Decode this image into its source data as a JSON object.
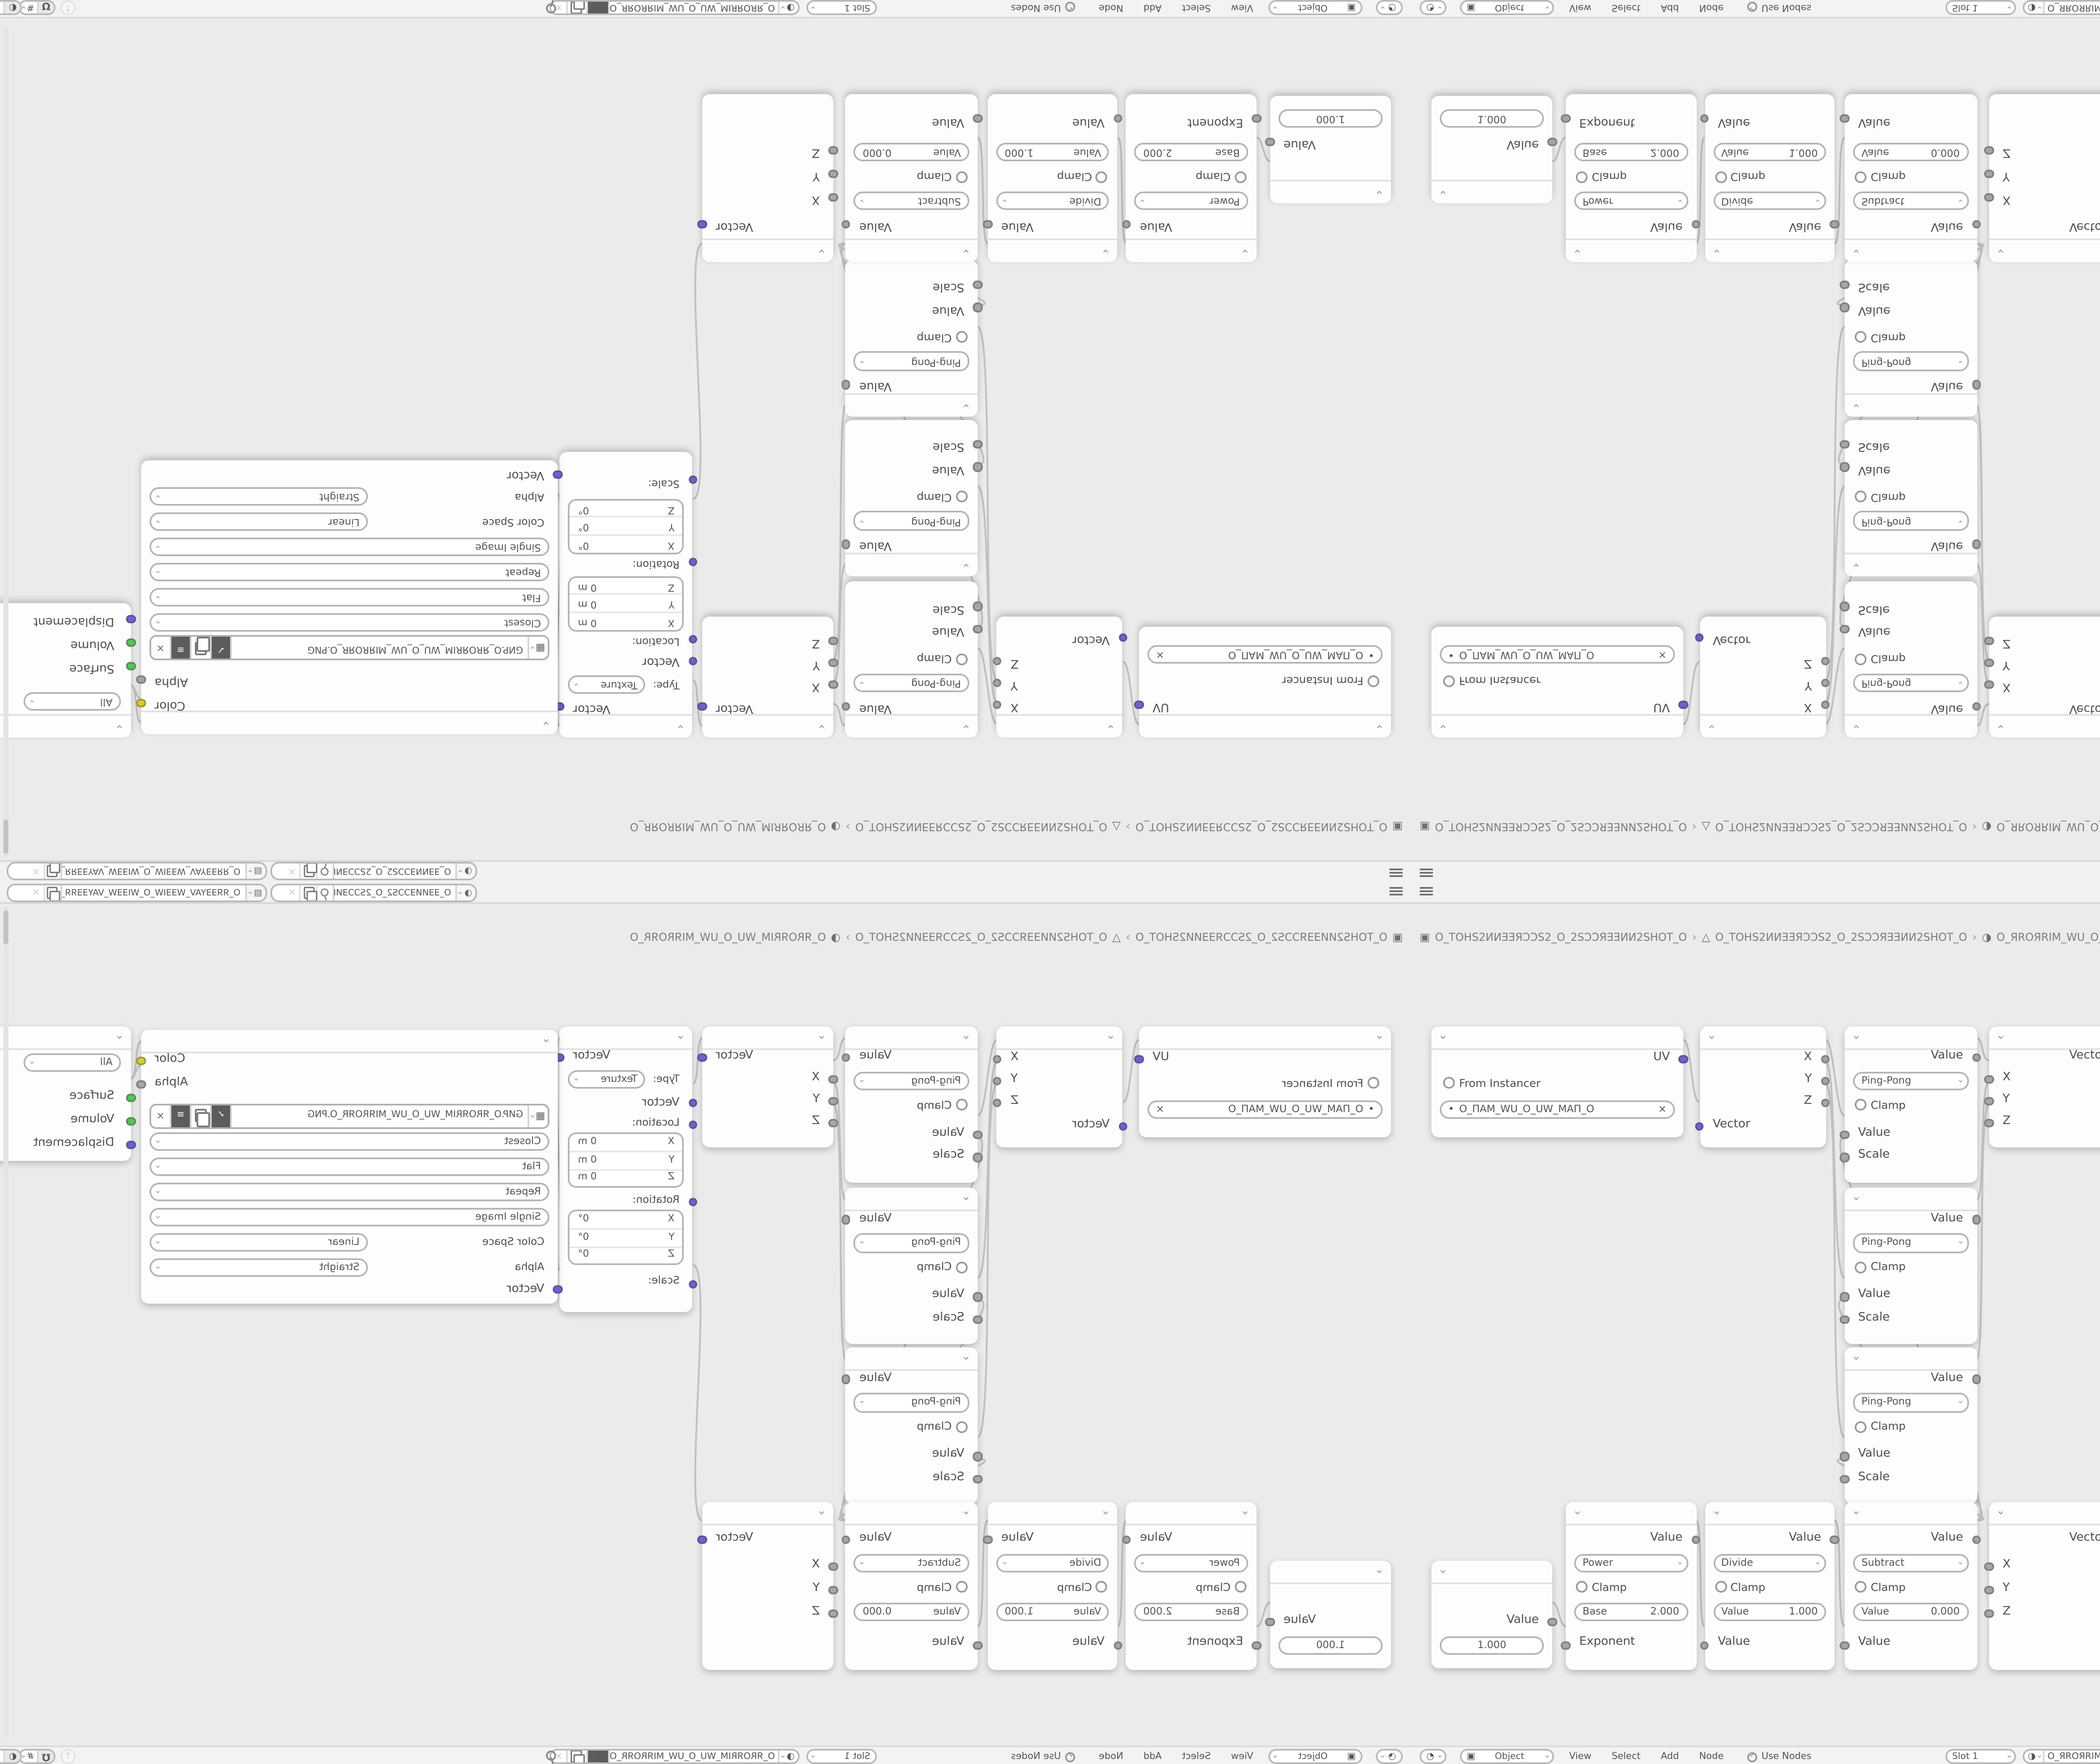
{
  "colors": {
    "editor_bg": "#ebebeb",
    "bar_bg": "#f2f2f2",
    "node_bg": "#fdfdfd",
    "socket_vector": "#6a64cb",
    "socket_value": "#a6a6a6",
    "socket_color": "#d6cc33",
    "socket_shader": "#5cc05c",
    "link": "#bdbdbd"
  },
  "icons": {
    "hamburger_menu": "≡",
    "scene": "◑",
    "viewlayer": "▤",
    "object": "▣",
    "mesh_data": "△",
    "material_sphere": "◑",
    "shader_ball": "◔",
    "overlay_ball": "◐",
    "image_browse": "▦",
    "snap_grid": "#",
    "check": "✓",
    "close": "×",
    "up_arrow": "↑",
    "crumb_sep": "›",
    "shield_check": "✓",
    "dot": "•"
  },
  "topbar": {
    "scene_name": "O_ƎƎИИƎƆƆS2_O_2SƆƆƎИИƎƎ_O",
    "viewlayer_name": "O_ЯЯƎƎYAV_WƎƎIW_O_WIƎƎW_VAYƎƎЯЯ_O"
  },
  "breadcrumb": {
    "scene": "O_TOHS2ИИƎƎЯƆƆS2_O_2SƆƆЯƎƎИИ2SHOT_O",
    "object": "O_TOHS2ИИƎƎЯƆƆS2_O_2SƆƆЯƎƎИИ2SHOT_O",
    "material": "O_ЯROЯRIM_WU_O_UW_MIЯROЯR_O"
  },
  "header": {
    "mode": "Object",
    "menu_view": "View",
    "menu_select": "Select",
    "menu_add": "Add",
    "menu_node": "Node",
    "use_nodes": "Use Nodes",
    "slot": "Slot 1",
    "material": "O_ЯROЯRIM_WU_O_UW_MIЯROЯR_O"
  },
  "nodes": {
    "uv_map": {
      "output": "UV",
      "from_instancer": "From Instancer",
      "uv_name": "O_ПAM_WU_O_UW_MAП_O"
    },
    "separate_xyz": {
      "out_x": "X",
      "out_y": "Y",
      "out_z": "Z",
      "input": "Vector"
    },
    "pingpong": {
      "output": "Value",
      "operation": "Ping-Pong",
      "clamp": "Clamp",
      "in_value": "Value",
      "in_scale": "Scale"
    },
    "combine_xyz": {
      "output": "Vector",
      "in_x": "X",
      "in_y": "Y",
      "in_z": "Z"
    },
    "mapping": {
      "output": "Vector",
      "type_label": "Type:",
      "type": "Texture",
      "input": "Vector",
      "location_label": "Location:",
      "rotation_label": "Rotation:",
      "scale_label": "Scale:",
      "location": [
        {
          "axis": "X",
          "value": "0 m"
        },
        {
          "axis": "Y",
          "value": "0 m"
        },
        {
          "axis": "Z",
          "value": "0 m"
        }
      ],
      "rotation": [
        {
          "axis": "X",
          "value": "0°"
        },
        {
          "axis": "Y",
          "value": "0°"
        },
        {
          "axis": "Z",
          "value": "0°"
        }
      ]
    },
    "image_texture": {
      "out_color": "Color",
      "out_alpha": "Alpha",
      "filename": "GИP.O_ЯROЯRIM_WU_O_UW_MIЯROЯR_O.PNG",
      "interpolation": "Closest",
      "projection": "Flat",
      "extension": "Repeat",
      "source": "Single Image",
      "color_space_label": "Color Space",
      "color_space": "Linear",
      "alpha_label": "Alpha",
      "alpha_mode": "Straight",
      "input": "Vector"
    },
    "material_output": {
      "target": "All",
      "in_surface": "Surface",
      "in_volume": "Volume",
      "in_displacement": "Displacement"
    },
    "value": {
      "output": "Value",
      "value": "1.000"
    },
    "power": {
      "output": "Value",
      "operation": "Power",
      "clamp": "Clamp",
      "field_label": "Base",
      "field_value": "2.000",
      "input": "Exponent"
    },
    "divide": {
      "output": "Value",
      "operation": "Divide",
      "clamp": "Clamp",
      "field_label": "Value",
      "field_value": "1.000",
      "input": "Value"
    },
    "subtract": {
      "output": "Value",
      "operation": "Subtract",
      "clamp": "Clamp",
      "field_label": "Value",
      "field_value": "0.000",
      "input": "Value"
    }
  }
}
